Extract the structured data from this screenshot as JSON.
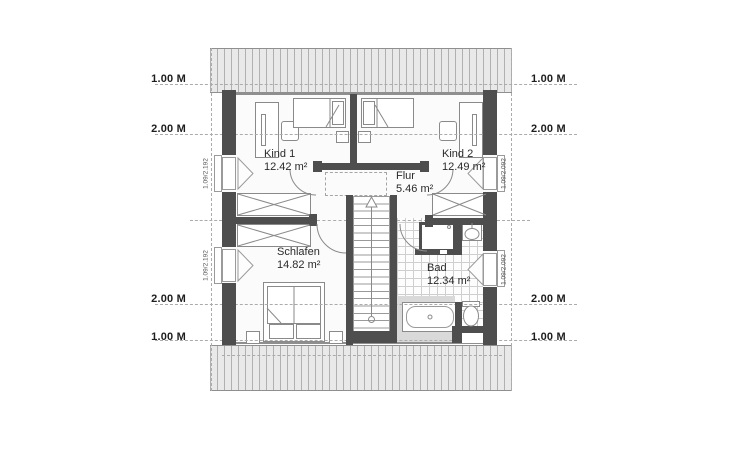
{
  "plan_title": "Dachgeschoss Grundriss",
  "rooms": {
    "kind1": {
      "name": "Kind 1",
      "area": "12.42 m²"
    },
    "kind2": {
      "name": "Kind 2",
      "area": "12.49 m²"
    },
    "flur": {
      "name": "Flur",
      "area": "5.46 m²"
    },
    "schlafen": {
      "name": "Schlafen",
      "area": "14.82 m²"
    },
    "bad": {
      "name": "Bad",
      "area": "12.34 m²"
    }
  },
  "dimension_lines": {
    "one_m": "1.00 M",
    "two_m": "2.00 M"
  },
  "window_labels": {
    "left": "1.09/2.192",
    "right": "1.09/2.092"
  },
  "colors": {
    "wall": "#4e4e4e",
    "roof_hatch_fill": "#e9e9e9",
    "roof_hatch_line": "#b0b0b0",
    "dashed_line": "#ababab",
    "floor": "#fbfbfb",
    "bad_floor_gray": "#d9d9d9",
    "furniture_line": "#8a8a8a",
    "text": "#222222"
  }
}
